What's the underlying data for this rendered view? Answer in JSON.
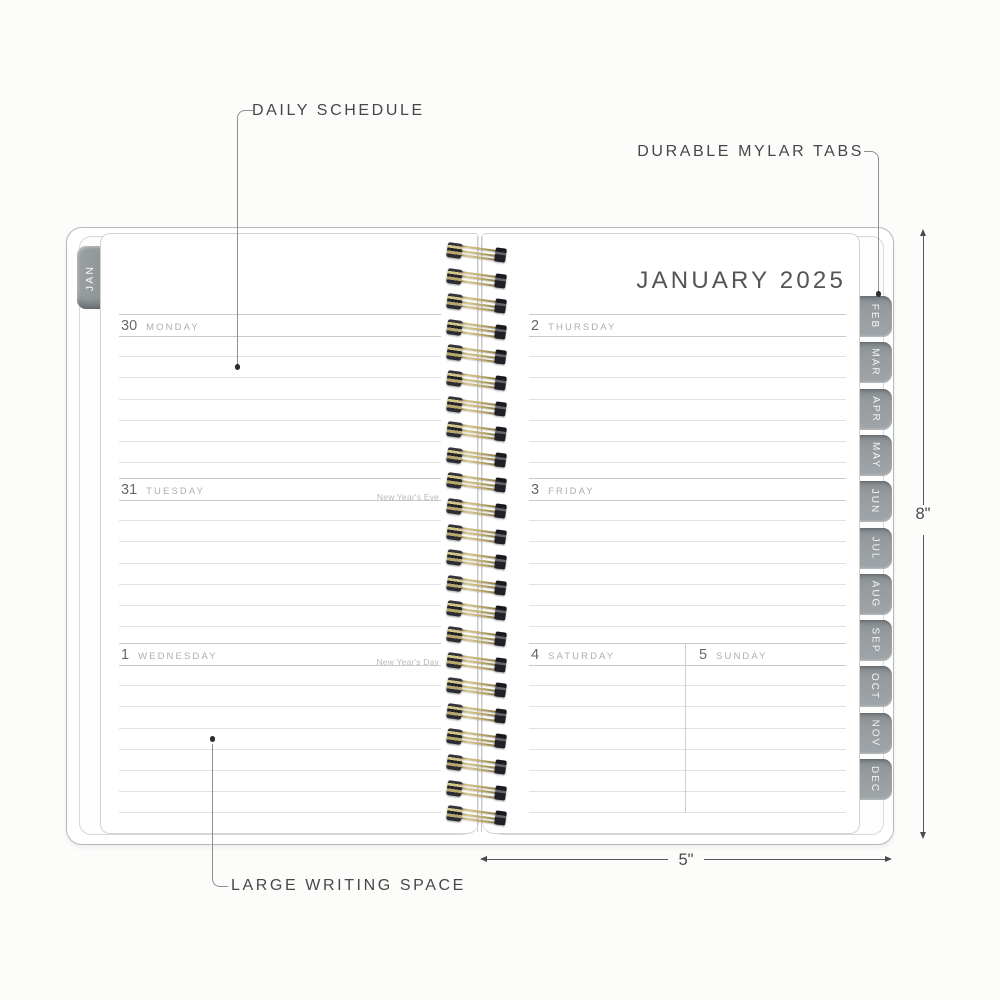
{
  "title": "JANUARY 2025",
  "callouts": {
    "daily_schedule": "DAILY SCHEDULE",
    "durable_mylar_tabs": "DURABLE MYLAR TABS",
    "large_writing_space": "LARGE WRITING SPACE"
  },
  "dimensions": {
    "height_label": "8\"",
    "width_label": "5\""
  },
  "tabs": {
    "left": "JAN",
    "right": [
      "FEB",
      "MAR",
      "APR",
      "MAY",
      "JUN",
      "JUL",
      "AUG",
      "SEP",
      "OCT",
      "NOV",
      "DEC"
    ]
  },
  "left_page": {
    "days": [
      {
        "date": "30",
        "name": "MONDAY",
        "holiday": ""
      },
      {
        "date": "31",
        "name": "TUESDAY",
        "holiday": "New Year's Eve"
      },
      {
        "date": "1",
        "name": "WEDNESDAY",
        "holiday": "New Year's Day"
      }
    ]
  },
  "right_page": {
    "days": [
      {
        "date": "2",
        "name": "THURSDAY",
        "holiday": ""
      },
      {
        "date": "3",
        "name": "FRIDAY",
        "holiday": ""
      }
    ],
    "weekend": [
      {
        "date": "4",
        "name": "SATURDAY"
      },
      {
        "date": "5",
        "name": "SUNDAY"
      }
    ]
  },
  "colors": {
    "tab_gray": "#969c9f",
    "wire_gold": "#b3a266",
    "rule_line": "#e1e1e1",
    "header_line": "#c9c9c9",
    "annotation": "#474747"
  }
}
